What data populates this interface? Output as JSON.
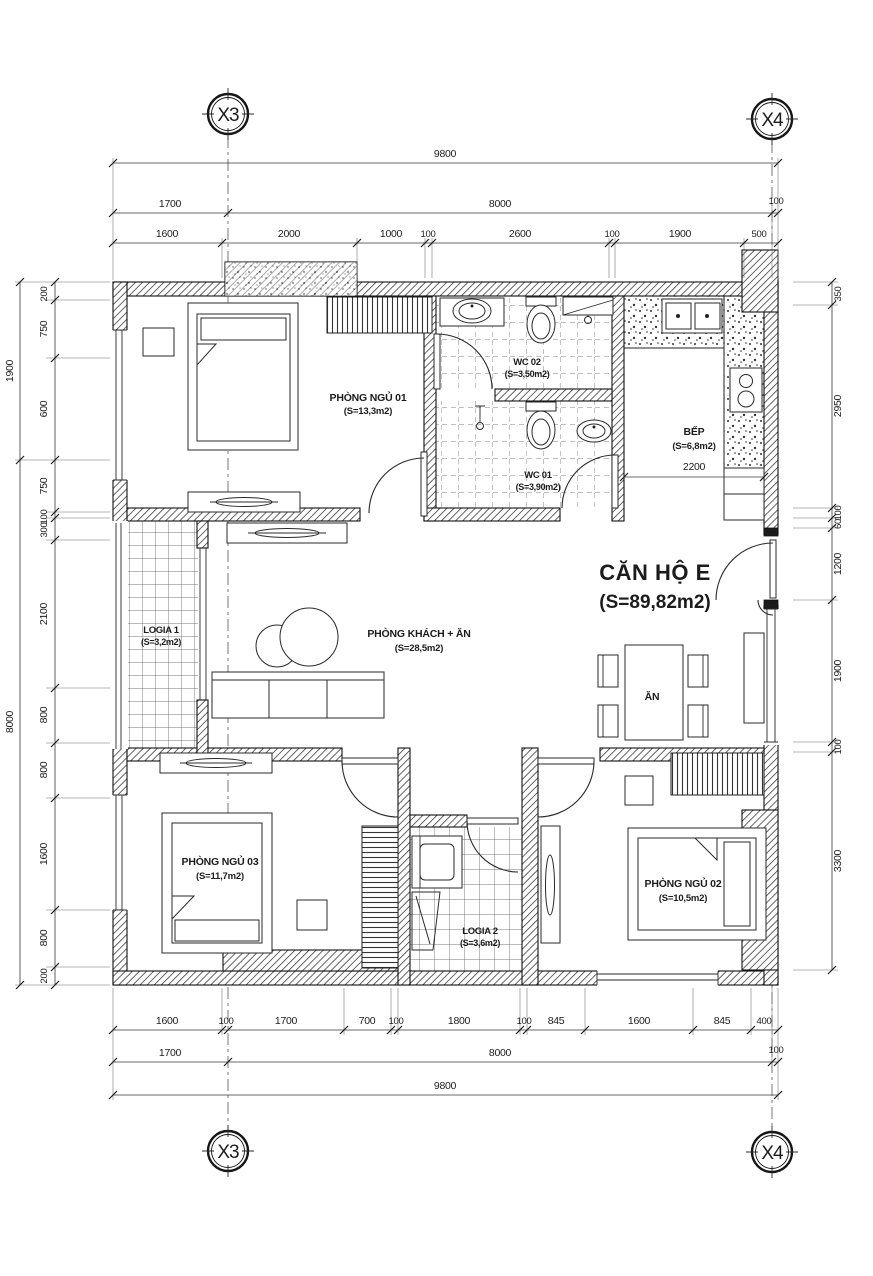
{
  "axes": {
    "x3": "X3",
    "x4": "X4"
  },
  "rooms": {
    "apartment": {
      "name": "CĂN HỘ E",
      "area": "(S=89,82m2)"
    },
    "bed01": {
      "name": "PHÒNG NGỦ 01",
      "area": "(S=13,3m2)"
    },
    "bed02": {
      "name": "PHÒNG NGỦ 02",
      "area": "(S=10,5m2)"
    },
    "bed03": {
      "name": "PHÒNG NGỦ 03",
      "area": "(S=11,7m2)"
    },
    "wc01": {
      "name": "WC 01",
      "area": "(S=3,90m2)"
    },
    "wc02": {
      "name": "WC 02",
      "area": "(S=3,50m2)"
    },
    "kitchen": {
      "name": "BẾP",
      "area": "(S=6,8m2)",
      "dim": "2200"
    },
    "living": {
      "name": "PHÒNG KHÁCH + ĂN",
      "area": "(S=28,5m2)"
    },
    "dining": {
      "label": "ĂN"
    },
    "logia1": {
      "name": "LOGIA 1",
      "area": "(S=3,2m2)"
    },
    "logia2": {
      "name": "LOGIA 2",
      "area": "(S=3,6m2)"
    }
  },
  "dims": {
    "top": {
      "total": "9800",
      "mid": [
        "1700",
        "8000",
        "100"
      ],
      "inner": [
        "1600",
        "2000",
        "1000",
        "100",
        "2600",
        "100",
        "1900",
        "500"
      ]
    },
    "bottom": {
      "inner": [
        "1600",
        "100",
        "1700",
        "700",
        "100",
        "1800",
        "100",
        "845",
        "1600",
        "845",
        "400"
      ],
      "mid": [
        "1700",
        "8000",
        "100"
      ],
      "total": "9800"
    },
    "left": {
      "outer": [
        "1900",
        "8000"
      ],
      "inner": [
        "200",
        "750",
        "600",
        "750",
        "100",
        "300",
        "2100",
        "800",
        "800",
        "1600",
        "800",
        "200"
      ]
    },
    "right": {
      "inner": [
        "350",
        "2950",
        "100",
        "60",
        "1200",
        "1900",
        "100",
        "3300"
      ]
    }
  },
  "colors": {
    "ink": "#1c1c1c",
    "paper": "#ffffff"
  }
}
